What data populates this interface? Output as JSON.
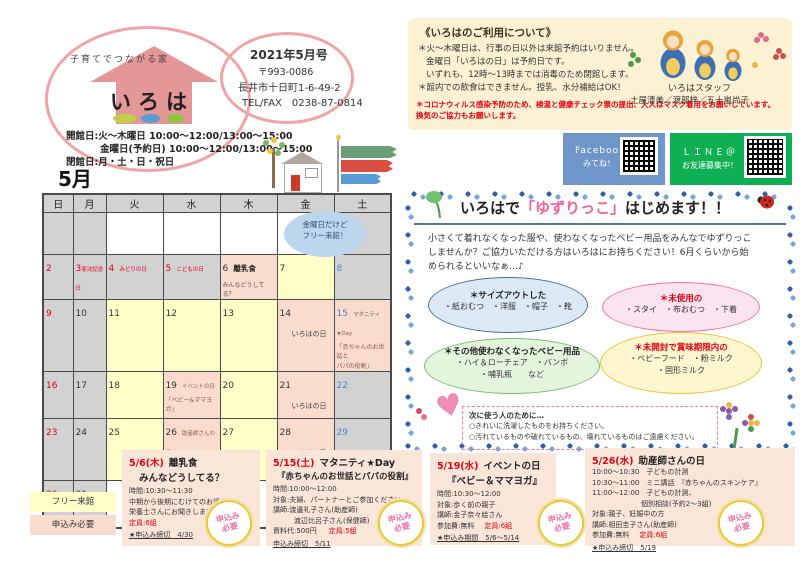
{
  "header": {
    "tagline": "子育てでつながる家",
    "logo": "いろは",
    "issue": "2021年5月号",
    "postal": "〒993-0086",
    "address": "長井市十日町1-6-49-2",
    "telfax": "TEL/FAX　0238-87-0814",
    "open1": "開館日:火～木曜日 10:00～12:00/13:00～15:00",
    "open2": "金曜日(予約日) 10:00～12:00/13:00～15:00",
    "closed": "閉館日:月・土・日・祝日",
    "month": "5月"
  },
  "usage": {
    "title": "《いろはのご利用について》",
    "line1": "＊火～木曜日は、行事の日以外は来館予約はいりません。",
    "line2": "金曜日「いろはの日」は予約日です。",
    "line3": "いずれも、12時～13時までは消毒のため閉館します。",
    "line4": "＊館内での飲食はできません。授乳、水分補給はOK！",
    "warning1": "＊コロナウィルス感染予防のため、検温と健康チェック票の提出、大人はマスク着用をお願いしています。",
    "warning2": "換気のご協力もお願いします。",
    "staff_label": "いろはスタッフ",
    "staff_names": "土屋清美／渡部梓／五十嵐尚子"
  },
  "social": {
    "fb1": "Facebook",
    "fb2": "みてね！",
    "line1": "ＬＩＮＥ＠",
    "line2": "お友達募集中！"
  },
  "calendar": {
    "bubble1": "金曜日だけど",
    "bubble2": "フリー来館！",
    "weekdays": [
      "日",
      "月",
      "火",
      "水",
      "木",
      "金",
      "土"
    ],
    "cells": [
      {},
      {},
      {},
      {},
      {},
      {},
      {
        "d": "1"
      },
      {
        "d": "2"
      },
      {
        "d": "3",
        "inline": "憲法記念日"
      },
      {
        "d": "4",
        "inline": "みどりの日"
      },
      {
        "d": "5",
        "inline": "こどもの日"
      },
      {
        "d": "6",
        "inline": "離乳食",
        "below1": "みんなどうしてる？"
      },
      {
        "d": "7"
      },
      {
        "d": "8"
      },
      {
        "d": "9"
      },
      {
        "d": "10"
      },
      {
        "d": "11"
      },
      {
        "d": "12"
      },
      {
        "d": "13"
      },
      {
        "d": "14",
        "below1": "いろはの日"
      },
      {
        "d": "15",
        "inline": "マタニティ★Day",
        "below1": "「赤ちゃんのお世話と",
        "below2": "パパの役割」"
      },
      {
        "d": "16"
      },
      {
        "d": "17"
      },
      {
        "d": "18"
      },
      {
        "d": "19",
        "inline": "イベントの日",
        "below1": "「ベビー&ママヨガ」"
      },
      {
        "d": "20"
      },
      {
        "d": "21",
        "below1": "いろはの日"
      },
      {
        "d": "22"
      },
      {
        "d": "23"
      },
      {
        "d": "24"
      },
      {
        "d": "25"
      },
      {
        "d": "26",
        "inline": "助産師さんの日",
        "below1": "「赤ちゃんのスキンケア」"
      },
      {
        "d": "27"
      },
      {
        "d": "28",
        "below1": "いろはの日"
      },
      {
        "d": "29"
      },
      {
        "d": "30"
      },
      {
        "d": "31"
      },
      {},
      {},
      {},
      {},
      {}
    ]
  },
  "legend": {
    "free": "フリー来館",
    "need": "申込み必要"
  },
  "yuzu": {
    "t1": "いろはで",
    "t2": "「ゆずりっこ」",
    "t3": "はじめます！！",
    "body1": "小さくて着れなくなった服や、使わなくなったベビー用品をみんなでゆずりっこ",
    "body2": "しませんか？ご協力いただける方はいろはにお持ちください！6月くらいから始",
    "body3": "められるといいなぁ…♪",
    "oval1_label": "＊サイズアウトした",
    "oval1_items": "・紙おむつ　・洋服　・帽子　・靴",
    "oval2_label": "＊未使用の",
    "oval2_items": "・スタイ　・布おむつ　・下着",
    "oval3_label": "＊その他使わなくなったベビー用品",
    "oval3_items1": "・ハイ＆ローチェア　・バンボ",
    "oval3_items2": "・哺乳瓶　　など",
    "oval4_label": "＊未開封で賞味期限内の",
    "oval4_items1": "・ベビーフード　・粉ミルク",
    "oval4_items2": "・固形ミルク",
    "notice_title": "次に使う人のために…",
    "notice1": "○きれいに洗濯したものをお持ちください。",
    "notice2": "○汚れているものや破れているもの、壊れているものはご遠慮ください。"
  },
  "events": [
    {
      "date": "5/6(木)",
      "title": "離乳食",
      "subtitle": "みんなどうしてる？",
      "lines": [
        "時間:10:30～11:30",
        "中期から後期にむけてのお話を",
        "栄養士さんにお聞きします。"
      ],
      "capacity": "定員:6組",
      "deadline": "★申込み締切　4/30"
    },
    {
      "date": "5/15(土)",
      "title": "マタニティ★Day",
      "subtitle": "『赤ちゃんのお世話とパパの役割』",
      "lines": [
        "時間:10:00～12:00",
        "対象:夫婦、パートナーとご参加ください。",
        "講師:渡邊礼子さん(助産師)",
        "　　　渡辺比呂子さん(保健師)"
      ],
      "fee": "資料代:500円",
      "capacity": "定員:5組",
      "deadline": "申込み締切　5/11"
    },
    {
      "date": "5/19(水)",
      "title": "イベントの日",
      "subtitle": "『ベビー＆ママヨガ』",
      "lines": [
        "時間:10:30～12:00",
        "対象:歩く前の親子",
        "講師:金子奈々絵さん"
      ],
      "fee": "参加費:無料",
      "capacity": "定員:6組",
      "deadline": "★申込み期間　5/6～5/14"
    },
    {
      "date": "5/26(水)",
      "title": "助産師さんの日",
      "lines": [
        "10:00～10:30　子どもの計測",
        "10:30～11:00　ミニ講話　『赤ちゃんのスキンケア』",
        "11:00～12:00　子どもの計測、",
        "　　　　　　　個別相談(予約2～3組)",
        "対象:親子、妊娠中の方",
        "講師:相田圭子さん(助産師)"
      ],
      "fee": "参加費:無料",
      "capacity": "定員:6組",
      "deadline": "★申込み締切　5/19"
    }
  ],
  "stamp": {
    "l1": "申込み",
    "l2": "必要"
  }
}
